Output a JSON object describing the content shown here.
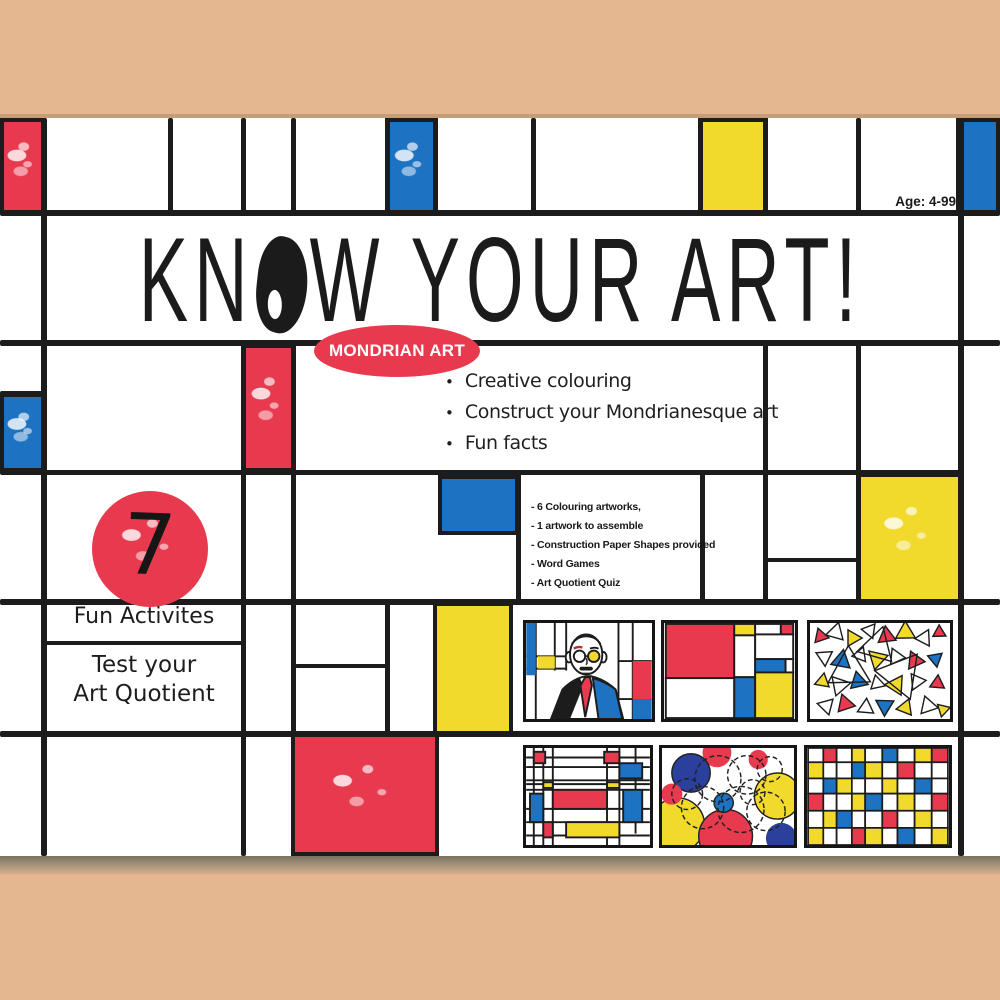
{
  "palette": {
    "red": "#e83a4e",
    "blue": "#1d72c2",
    "yellow": "#f2da2d",
    "navy": "#2b3f9c",
    "line": "#1c1c1c",
    "tan": "#e4b791",
    "card": "#ffffff"
  },
  "header": {
    "age_label": "Age: 4-99"
  },
  "title": {
    "full": "KNOW YOUR ART!",
    "pre": "KN",
    "post": "W YOUR ART!"
  },
  "badge": {
    "label": "MONDRIAN ART"
  },
  "highlights": {
    "bullet_glyph": "•",
    "items": [
      "Creative colouring",
      "Construct your Mondrianesque art",
      "Fun facts"
    ]
  },
  "contents": {
    "items": [
      "- 6 Colouring artworks,",
      "- 1 artwork to assemble",
      "- Construction Paper Shapes provided",
      "- Word Games",
      "- Art Quotient Quiz"
    ]
  },
  "activities": {
    "count": "7",
    "label": "Fun Activites",
    "tagline_line1": "Test your",
    "tagline_line2": "Art Quotient"
  },
  "thumbnails": {
    "items": [
      "mondrian-portrait",
      "composition-with-squares",
      "triangle-scatter",
      "line-composition",
      "circle-composition",
      "mini-grid-composition"
    ]
  }
}
